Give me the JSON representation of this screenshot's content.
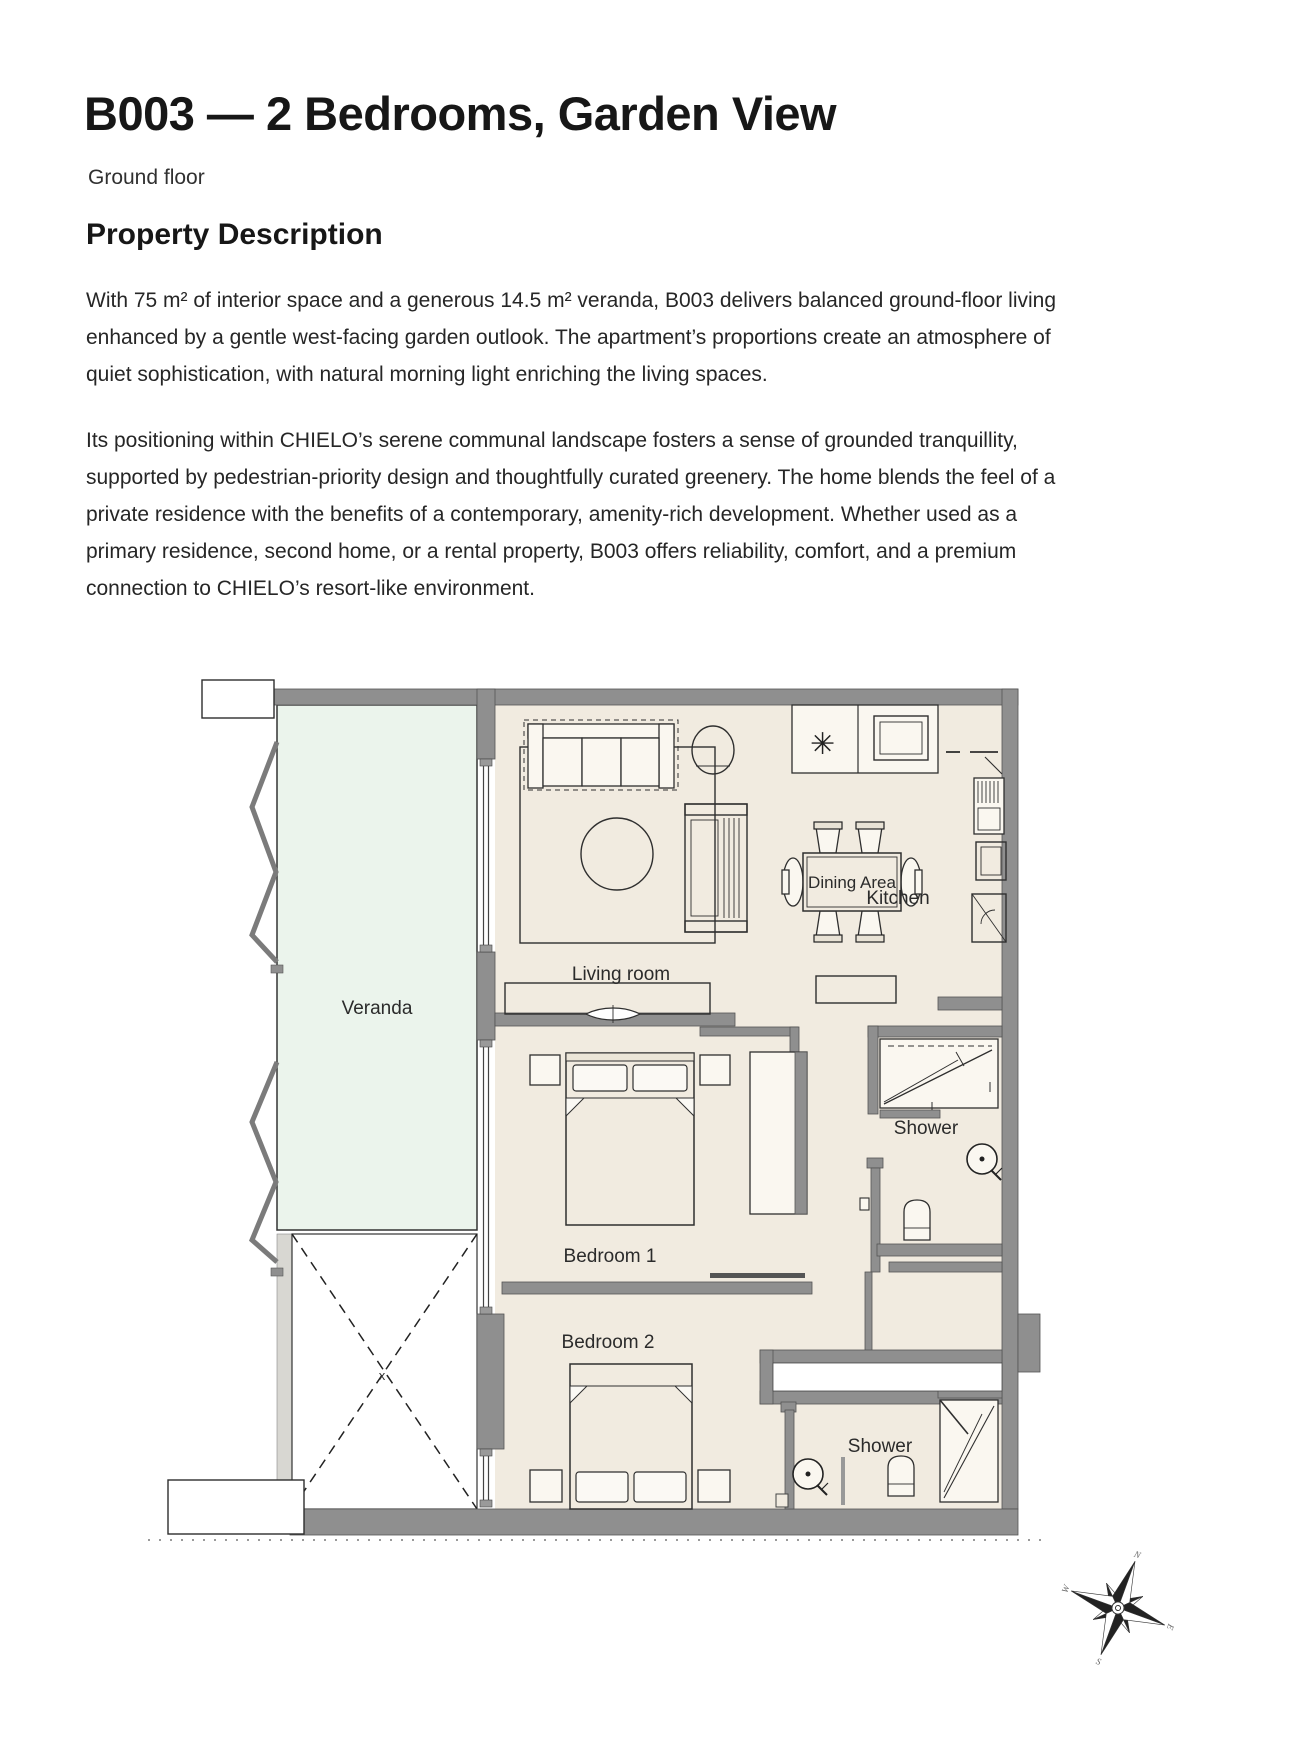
{
  "page": {
    "title": "B003 — 2 Bedrooms, Garden View",
    "subtitle": "Ground floor",
    "section_heading": "Property Description",
    "paragraph_1": "With 75 m² of interior space and a generous 14.5 m² veranda, B003 delivers balanced ground-floor living enhanced by a gentle west-facing garden outlook. The apartment’s proportions create an atmosphere of quiet sophistication, with natural morning light enriching the living spaces.",
    "paragraph_2": "Its positioning within CHIELO’s serene communal landscape fosters a sense of grounded tranquillity, supported by pedestrian-priority design and thoughtfully curated greenery. The home blends the feel of a private residence with the benefits of a contemporary, amenity-rich development. Whether used as a primary residence, second home, or a rental property, B003 offers reliability, comfort, and a premium connection to CHIELO’s resort-like environment."
  },
  "floorplan": {
    "labels": {
      "veranda": "Veranda",
      "living_room": "Living room",
      "kitchen": "Kitchen",
      "dining_area": "Dining Area",
      "bedroom_1": "Bedroom 1",
      "bedroom_2": "Bedroom 2",
      "shower_top": "Shower",
      "shower_bottom": "Shower",
      "patio_mark": "x",
      "burner_symbol": "✳"
    },
    "compass": {
      "north": "N",
      "east": "E",
      "south": "S",
      "west": "W"
    },
    "colors": {
      "wall": "#8f8f8f",
      "interior_floor": "#f1ebe0",
      "veranda_floor": "#ebf4ec",
      "paving": "#d8d7d2",
      "line": "#2f2f2f"
    }
  }
}
